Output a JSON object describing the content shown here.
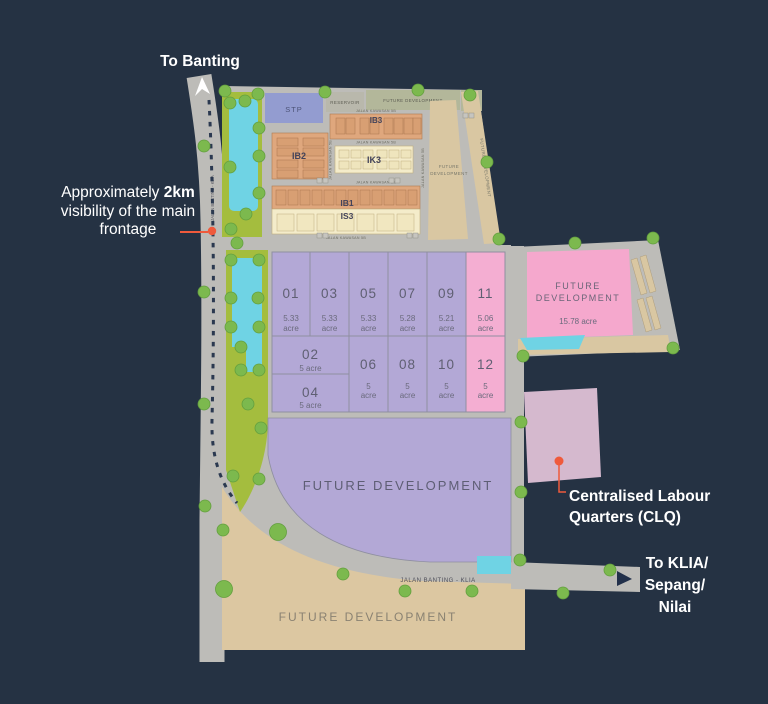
{
  "annotations": {
    "to_banting": "To Banting",
    "visibility_pre": "Approximately ",
    "visibility_bold": "2km",
    "visibility_l2": "visibility of the main",
    "visibility_l3": "frontage",
    "clq_l1": "Centralised Labour",
    "clq_l2": "Quarters (CLQ)",
    "klia_l1": "To KLIA/",
    "klia_l2": "Sepang/",
    "klia_l3": "Nilai"
  },
  "facilities": {
    "stp": "STP",
    "reservoir": "RESERVOIR",
    "ppu": "PPU"
  },
  "blocks": {
    "ib3": "IB3",
    "ib2": "IB2",
    "ik3": "IK3",
    "ib1": "IB1",
    "is3": "IS3"
  },
  "future_development": {
    "top": "FUTURE DEVELOPMENT",
    "central_l1": "FUTURE",
    "central_l2": "DEVELOPMENT",
    "right_strip": "FUTURE DEVELOPMENT",
    "pink_l1": "FUTURE",
    "pink_l2": "DEVELOPMENT",
    "pink_acreage": "15.78 acre",
    "main": "FUTURE DEVELOPMENT",
    "bottom": "FUTURE DEVELOPMENT"
  },
  "roads": {
    "banting_klia": "JALAN BANTING - KLIA",
    "banting_klia_side": "JALAN BANTING - KLIA",
    "kawasan": "JALAN KAWASAN 5B"
  },
  "plots": [
    {
      "num": "01",
      "a1": "5.33",
      "a2": "acre"
    },
    {
      "num": "02",
      "a1": "5 acre",
      "a2": ""
    },
    {
      "num": "03",
      "a1": "5.33",
      "a2": "acre"
    },
    {
      "num": "04",
      "a1": "5 acre",
      "a2": ""
    },
    {
      "num": "05",
      "a1": "5.33",
      "a2": "acre"
    },
    {
      "num": "06",
      "a1": "5",
      "a2": "acre"
    },
    {
      "num": "07",
      "a1": "5.28",
      "a2": "acre"
    },
    {
      "num": "08",
      "a1": "5",
      "a2": "acre"
    },
    {
      "num": "09",
      "a1": "5.21",
      "a2": "acre"
    },
    {
      "num": "10",
      "a1": "5",
      "a2": "acre"
    },
    {
      "num": "11",
      "a1": "5.06",
      "a2": "acre"
    },
    {
      "num": "12",
      "a1": "5",
      "a2": "acre"
    }
  ],
  "colors": {
    "background": "#253243",
    "road": "#bdbcb8",
    "plot_purple": "#b3a8d6",
    "plot_pink": "#f4aed2",
    "industrial_orange": "#dfa77d",
    "industrial_cream": "#f4ecca",
    "future_tan": "#d9c7a2",
    "green_buffer": "#a4bd3e",
    "tree_green": "#7cb94e",
    "water_cyan": "#6fd3e4",
    "stp_blue": "#939cd0",
    "clq_mauve": "#d5b9ce",
    "accent_red": "#ef5a3c"
  }
}
